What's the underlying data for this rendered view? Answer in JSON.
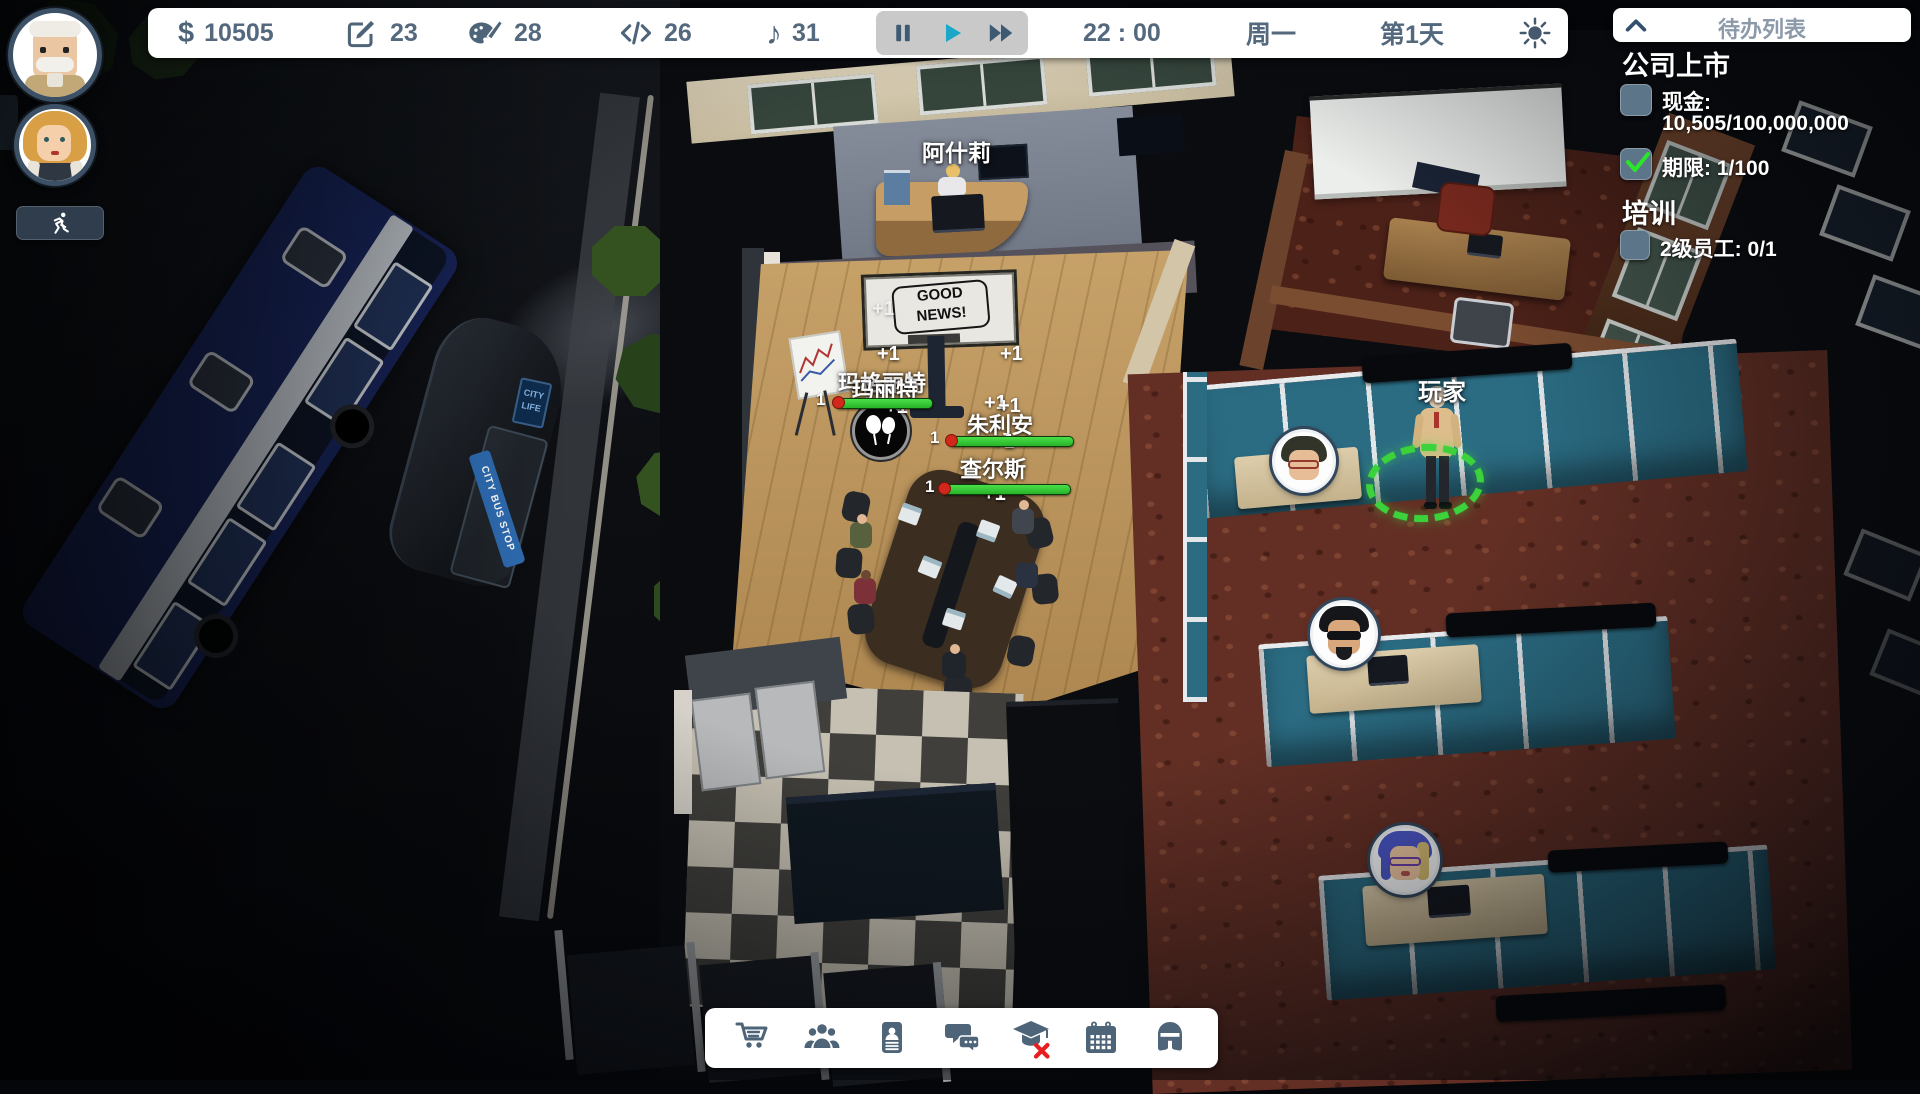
{
  "topbar": {
    "money_glyph": "$",
    "money": "10505",
    "design_points": "23",
    "art_points": "28",
    "code_points": "26",
    "audio_glyph": "♪",
    "audio_points": "31",
    "time": "22 : 00",
    "weekday": "周一",
    "day": "第1天"
  },
  "todo": {
    "title": "待办列表",
    "ipo": {
      "heading": "公司上市",
      "cash_label": "现金:",
      "cash_value": "10,505/100,000,000",
      "deadline_label": "期限:",
      "deadline_value": "1/100"
    },
    "training": {
      "heading": "培训",
      "staff_label": "2级员工:",
      "staff_value": "0/1"
    }
  },
  "scene": {
    "receptionist_name": "阿什莉",
    "name_margaret": "玛格丽特",
    "name_marit": "玛丽特",
    "name_julian": "朱利安",
    "name_charles": "查尔斯",
    "player_name": "玩家",
    "tv_line1": "GOOD",
    "tv_line2": "NEWS!",
    "plus_one": "+1",
    "bar_value": "1",
    "bus_stop_sign": "CITY BUS STOP",
    "poster_top": "CITY",
    "poster_bottom": "LIFE"
  },
  "toolbar": {
    "icons": [
      "cart",
      "team",
      "contacts",
      "chat",
      "training",
      "calendar",
      "equipment"
    ],
    "training_disabled": true
  },
  "colors": {
    "ui_slate": "#4e6478",
    "play_active": "#1ba7c7",
    "progress_green": "#2ed32e",
    "selection_green": "#3bd23b",
    "alert_red": "#e61e1e",
    "check_green": "#2ae62a"
  }
}
